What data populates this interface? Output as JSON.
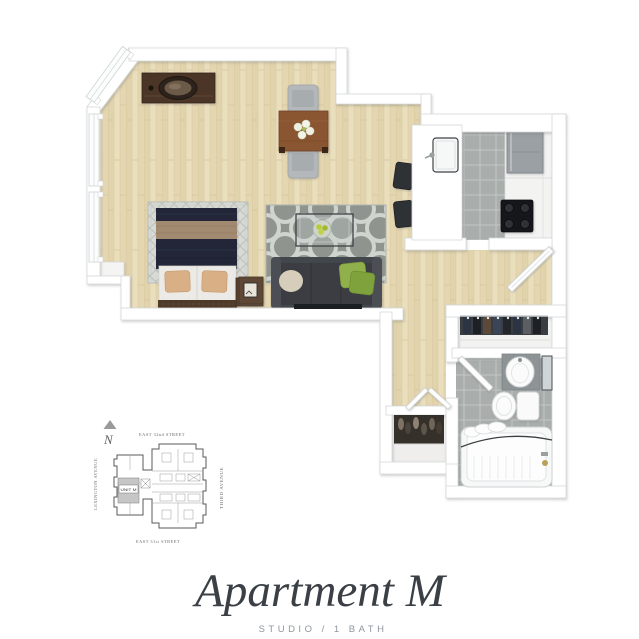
{
  "title": {
    "text": "Apartment M",
    "subtitle": "STUDIO / 1 BATH"
  },
  "site_plan": {
    "compass_label": "N",
    "street_north": "EAST 32nd STREET",
    "street_south": "EAST 31st STREET",
    "avenue_west": "LEXINGTON AVENUE",
    "avenue_east": "THIRD AVENUE",
    "unit_label": "UNIT M"
  },
  "floor_plan": {
    "type": "3d-rendered-top-down-studio",
    "features": [
      "dresser-with-oval-mirror",
      "dining-table-with-flowers",
      "two-dining-chairs",
      "bed-with-navy-duvet",
      "bed-area-rug",
      "nightstands",
      "quatrefoil-area-rug",
      "sofa-with-pillows",
      "glass-coffee-table",
      "side-table",
      "tv-console",
      "kitchen-peninsula-with-sink",
      "two-bar-stools",
      "refrigerator",
      "stove",
      "kitchen-cabinets",
      "entry-door-open",
      "wardrobe-closet-with-clothes",
      "shoe-closet",
      "bathroom-sink-vanity",
      "medicine-cabinet-mirror",
      "toilet",
      "bathtub-with-shower-curtain",
      "bay-windows"
    ]
  },
  "colors": {
    "background": "#ffffff",
    "wall": "#ffffff",
    "wall_outline": "#d6d8d9",
    "wood_floor": "#e6d9b5",
    "kitchen_tile": "#a9aeac",
    "bath_tile": "#aeb3b2",
    "rug_gray": "#8f948f",
    "rug_pattern": "#cfd4cf",
    "bed_navy": "#202839",
    "bed_tan": "#a18a6f",
    "sofa_charcoal": "#43474b",
    "pillow_green": "#8fb04b",
    "furniture_brown": "#4b3627",
    "title_color": "#3a4046",
    "subtitle_color": "#8f969c"
  }
}
